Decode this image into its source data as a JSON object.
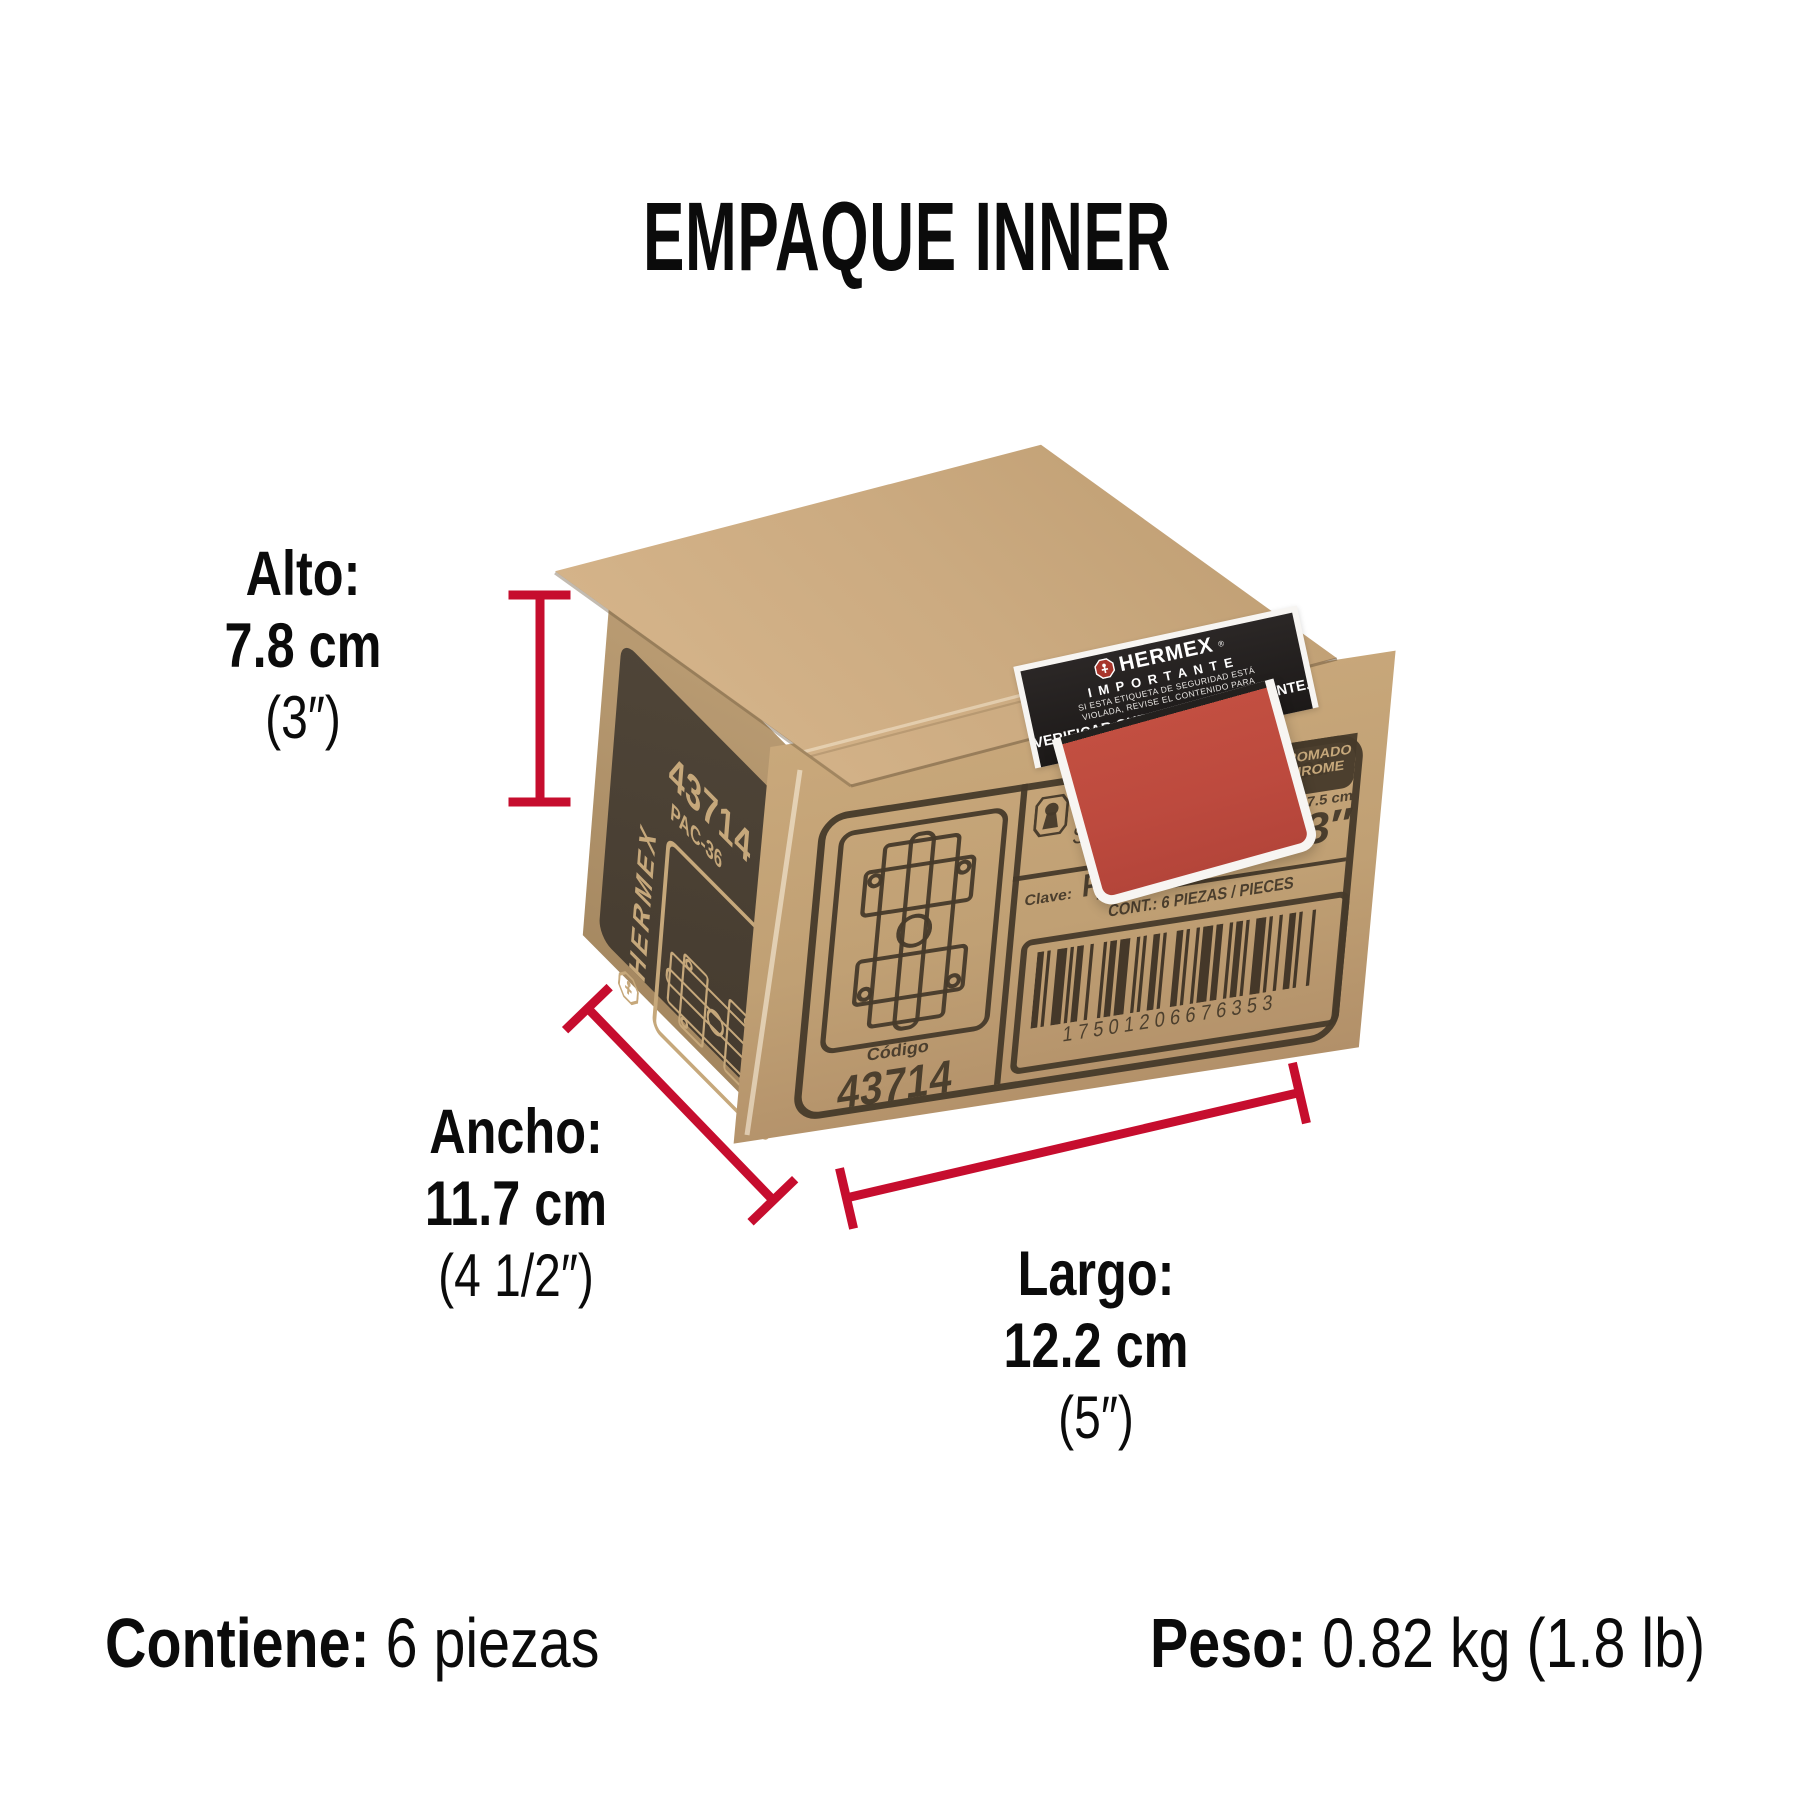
{
  "title": "EMPAQUE INNER",
  "dimensions": {
    "alto": {
      "label": "Alto:",
      "cm": "7.8 cm",
      "inch": "(3″)"
    },
    "ancho": {
      "label": "Ancho:",
      "cm": "11.7 cm",
      "inch": "(4 1/2″)"
    },
    "largo": {
      "label": "Largo:",
      "cm": "12.2 cm",
      "inch": "(5″)"
    }
  },
  "footer": {
    "contains_label": "Contiene:",
    "contains_value": "6 piezas",
    "weight_label": "Peso:",
    "weight_value": "0.82 kg (1.8 lb)"
  },
  "box": {
    "side": {
      "brand": "HERMEX",
      "code": "43714",
      "model": "PAC-36"
    },
    "front": {
      "name_es": "Pasador de seguridad",
      "name_en": "Surface slide bolt",
      "clave_label": "Clave:",
      "clave": "PAC-36",
      "contents": "CONT.: 6 PIEZAS / PIECES",
      "barcode_number": "17501206676353",
      "codigo_label": "Código",
      "codigo": "43714",
      "finish_es": "CROMADO",
      "finish_en": "CHROME",
      "size_cm": "7.5 cm",
      "size_inch": "3″"
    },
    "label": {
      "brand": "HERMEX",
      "reg": "®",
      "title": "IMPORTANTE",
      "line1": "SI ESTA ETIQUETA DE SEGURIDAD ESTÁ",
      "line2": "VIOLADA, REVISE EL CONTENIDO PARA",
      "line3": "VERIFICAR QUE NO EXISTA FALTANTE."
    }
  },
  "colors": {
    "accent_red": "#c60d2e",
    "label_red": "#bd4a3e",
    "kraft": "#c2a176",
    "print_ink": "#46392a"
  }
}
